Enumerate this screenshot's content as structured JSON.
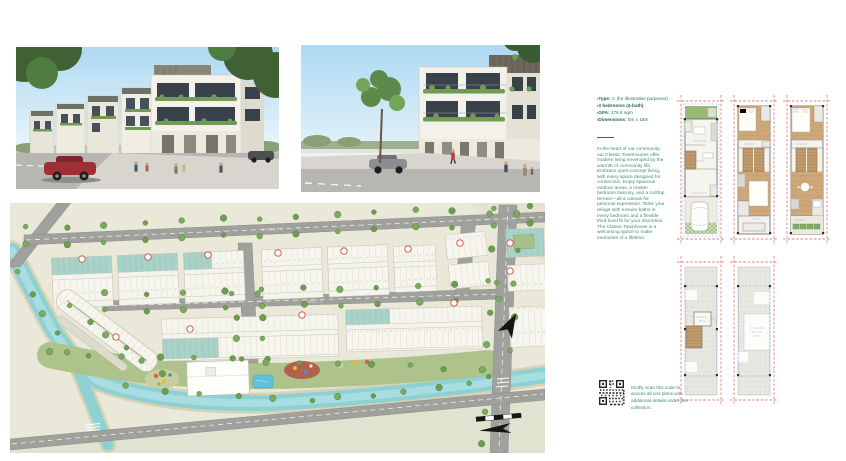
{
  "unit_info": {
    "bullets": [
      {
        "label": "Type:",
        "value": " C (for illustrative purposes)"
      },
      {
        "label": "3 bedrooms (4-bath)",
        "value": ""
      },
      {
        "label": "GFA:",
        "value": " 176.6 sqm"
      },
      {
        "label": "Dimensions:",
        "value": " 5m x 16m"
      }
    ],
    "description": "In the heart of our community, our Classic Townhouses offer modern living enveloped by the warmth of community life. Embrace open-concept living, with every space designed for connection. Enjoy spacious outdoor areas, a master bedroom balcony, and a rooftop terrace—all a canvas for personal expression. Tailor your refuge with ensuite baths in every bedroom and a flexible third-level fit for your discretion. The Classic Townhouse is a welcoming space to make memories of a lifetime."
  },
  "qr": {
    "caption": "Kindly scan this code to access all unit plans with additional details under this collection."
  },
  "site_plan": {
    "street_label_1": "STREET 1",
    "street_label_2": "STREET 2"
  },
  "colors": {
    "accent_teal_text": "#2e7065",
    "plan_boundary_red": "#dd5a4c",
    "setback_blue": "#8b9bd6",
    "canal_water": "#8ed1d5",
    "teal_roofs": "#a9d2c9"
  }
}
